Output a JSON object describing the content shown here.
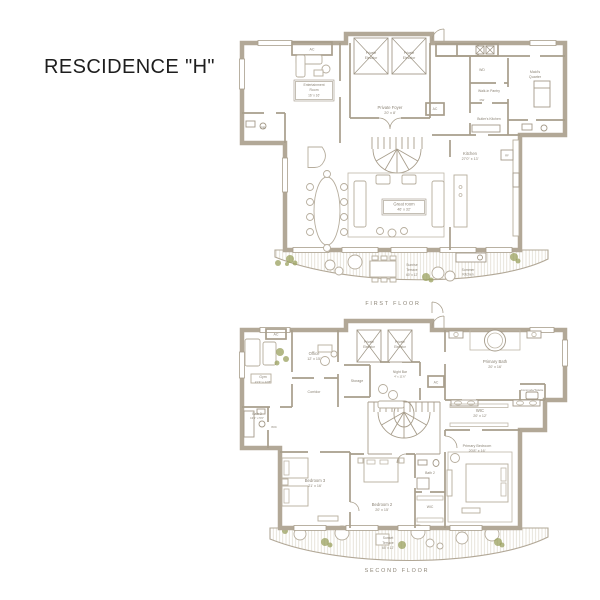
{
  "title": "RESCIDENCE \"H\"",
  "colors": {
    "wall": "#B2A897",
    "label_text": "#8C8476",
    "plant_accent": "#9AA05E",
    "title_text": "#1E1E1E",
    "background": "#FFFFFF"
  },
  "floors": [
    {
      "caption": "FIRST FLOOR",
      "rooms": [
        {
          "id": "entertainment-room",
          "lines": [
            "Entertainment",
            "Room",
            "16' x 16'"
          ]
        },
        {
          "id": "ac-closet",
          "lines": [
            "AC"
          ]
        },
        {
          "id": "powder-room",
          "lines": [
            "PR"
          ]
        },
        {
          "id": "private-elevator-1",
          "lines": [
            "Private",
            "Elevator"
          ]
        },
        {
          "id": "private-elevator-2",
          "lines": [
            "Private",
            "Elevator"
          ]
        },
        {
          "id": "private-foyer",
          "lines": [
            "Private Foyer",
            "20' x 8'"
          ]
        },
        {
          "id": "washer-dryer",
          "lines": [
            "WD"
          ]
        },
        {
          "id": "maids-quarter",
          "lines": [
            "Maid's",
            "Quarter"
          ]
        },
        {
          "id": "walk-in-pantry",
          "lines": [
            "Walk-in Pantry"
          ]
        },
        {
          "id": "butlers-kitchen",
          "lines": [
            "Butler's Kitchen"
          ]
        },
        {
          "id": "ac-closet-2",
          "lines": [
            "AC"
          ]
        },
        {
          "id": "kitchen",
          "lines": [
            "Kitchen",
            "27'0\" x 13'"
          ]
        },
        {
          "id": "great-room",
          "lines": [
            "Great room",
            "46' x 32'"
          ]
        },
        {
          "id": "refrigerator",
          "lines": [
            "RF"
          ]
        },
        {
          "id": "sunrise-terrace",
          "lines": [
            "Sunrise",
            "Terrace",
            "60' x 12'"
          ]
        },
        {
          "id": "summer-kitchen",
          "lines": [
            "Summer",
            "Kitchen"
          ]
        },
        {
          "id": "dishwasher",
          "lines": [
            "DW"
          ]
        }
      ]
    },
    {
      "caption": "SECOND FLOOR",
      "rooms": [
        {
          "id": "ac-closet",
          "lines": [
            "AC"
          ]
        },
        {
          "id": "gym",
          "lines": [
            "Gym",
            "21'3\" x 12'8\""
          ]
        },
        {
          "id": "office",
          "lines": [
            "Office",
            "12' x 15'"
          ]
        },
        {
          "id": "corridor",
          "lines": [
            "Corridor"
          ]
        },
        {
          "id": "storage",
          "lines": [
            "Storage"
          ]
        },
        {
          "id": "private-elevator-1",
          "lines": [
            "Private",
            "Elevator"
          ]
        },
        {
          "id": "private-elevator-2",
          "lines": [
            "Private",
            "Elevator"
          ]
        },
        {
          "id": "night-bar",
          "lines": [
            "Night Bar",
            "4' x 11'6\""
          ]
        },
        {
          "id": "ac-closet-2",
          "lines": [
            "AC"
          ]
        },
        {
          "id": "primary-bath",
          "lines": [
            "Primary Bath",
            "20' x 16'"
          ]
        },
        {
          "id": "commode-toilette",
          "lines": [
            "Commode/Toilette"
          ]
        },
        {
          "id": "wic-primary",
          "lines": [
            "WIC",
            "20' x 12'"
          ]
        },
        {
          "id": "bath-3",
          "lines": [
            "Bath 3",
            "13'1\" x 5'6\""
          ]
        },
        {
          "id": "wic-bedroom-3",
          "lines": [
            "WIC"
          ]
        },
        {
          "id": "bedroom-3",
          "lines": [
            "Bedroom 3",
            "21' x 16'"
          ]
        },
        {
          "id": "bedroom-2",
          "lines": [
            "Bedroom 2",
            "20' x 15'"
          ]
        },
        {
          "id": "bath-2",
          "lines": [
            "Bath 2"
          ]
        },
        {
          "id": "wic-bedroom-2",
          "lines": [
            "WIC"
          ]
        },
        {
          "id": "primary-bedroom",
          "lines": [
            "Primary Bedroom",
            "20'8\" x 16'"
          ]
        },
        {
          "id": "sunset-terrace",
          "lines": [
            "Sunset",
            "Terrace",
            "65' x 12'"
          ]
        }
      ]
    }
  ]
}
